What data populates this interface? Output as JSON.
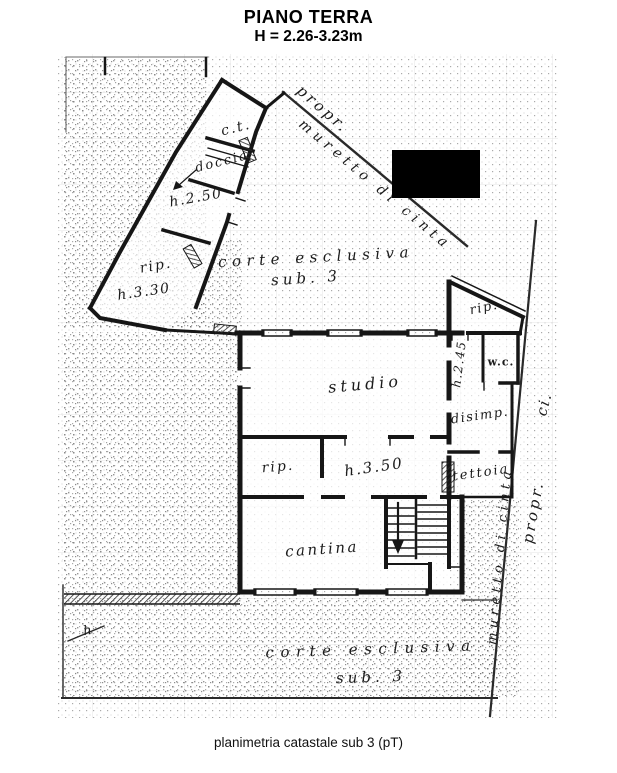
{
  "header": {
    "title": "PIANO TERRA",
    "subtitle": "H = 2.26-3.23m"
  },
  "caption": "planimetria catastale sub 3 (pT)",
  "colors": {
    "paper": "#ffffff",
    "ink": "#161616",
    "boundary": "#2a2a2a",
    "speckle": "#9b9b9b",
    "redaction": "#000000"
  },
  "plan": {
    "redaction_box": {
      "x": 392,
      "y": 150,
      "w": 88,
      "h": 48
    },
    "labels": [
      {
        "id": "ct",
        "text": "c.t.",
        "x": 236,
        "y": 128,
        "rot": -14,
        "size": 14,
        "ls": 2
      },
      {
        "id": "doccia",
        "text": "doccia",
        "x": 222,
        "y": 162,
        "rot": -14,
        "size": 13,
        "ls": 2
      },
      {
        "id": "h250",
        "text": "h.2.50",
        "x": 196,
        "y": 198,
        "rot": -10,
        "size": 14,
        "ls": 1.5
      },
      {
        "id": "rip-wing",
        "text": "rip.",
        "x": 156,
        "y": 266,
        "rot": -10,
        "size": 14,
        "ls": 2
      },
      {
        "id": "h330",
        "text": "h.3.30",
        "x": 144,
        "y": 292,
        "rot": -8,
        "size": 14,
        "ls": 1.5
      },
      {
        "id": "corte-top-line1",
        "text": "corte esclusiva",
        "x": 316,
        "y": 257,
        "rot": -3,
        "size": 15,
        "ls": 5.5
      },
      {
        "id": "corte-top-line2",
        "text": "sub. 3",
        "x": 306,
        "y": 278,
        "rot": -4,
        "size": 15,
        "ls": 4
      },
      {
        "id": "propr-top",
        "text": "propr.",
        "x": 323,
        "y": 109,
        "rot": 41,
        "size": 15,
        "ls": 3
      },
      {
        "id": "muretto-top",
        "text": "muretto di cinta",
        "x": 375,
        "y": 185,
        "rot": 40,
        "size": 14,
        "ls": 5
      },
      {
        "id": "studio",
        "text": "studio",
        "x": 365,
        "y": 384,
        "rot": -5,
        "size": 16,
        "ls": 4
      },
      {
        "id": "rip-right",
        "text": "rip.",
        "x": 484,
        "y": 308,
        "rot": -12,
        "size": 13,
        "ls": 1.5
      },
      {
        "id": "wc",
        "text": "w.c.",
        "x": 501,
        "y": 362,
        "rot": 0,
        "size": 11,
        "ls": 1,
        "bold": true
      },
      {
        "id": "h245",
        "text": "h.2.45",
        "x": 459,
        "y": 364,
        "rot": -83,
        "size": 12,
        "ls": 1.5
      },
      {
        "id": "disimp",
        "text": "disimp.",
        "x": 480,
        "y": 416,
        "rot": -8,
        "size": 13,
        "ls": 1.5
      },
      {
        "id": "rip-mid",
        "text": "rip.",
        "x": 278,
        "y": 467,
        "rot": -5,
        "size": 14,
        "ls": 2
      },
      {
        "id": "h350",
        "text": "h.3.50",
        "x": 374,
        "y": 467,
        "rot": -8,
        "size": 15,
        "ls": 2
      },
      {
        "id": "tettoia",
        "text": "tettoia",
        "x": 481,
        "y": 473,
        "rot": -8,
        "size": 13,
        "ls": 2
      },
      {
        "id": "cantina",
        "text": "cantina",
        "x": 322,
        "y": 549,
        "rot": -4,
        "size": 15,
        "ls": 2.5
      },
      {
        "id": "corte-bot-line1",
        "text": "corte esclusiva",
        "x": 371,
        "y": 649,
        "rot": -2,
        "size": 15,
        "ls": 6.5
      },
      {
        "id": "corte-bot-line2",
        "text": "sub. 3",
        "x": 371,
        "y": 677,
        "rot": -2,
        "size": 15,
        "ls": 4
      },
      {
        "id": "h-small",
        "text": "h",
        "x": 88,
        "y": 631,
        "rot": -10,
        "size": 13,
        "ls": 1
      },
      {
        "id": "muretto-right",
        "text": "muretto di cinta",
        "x": 500,
        "y": 556,
        "rot": -85,
        "size": 13,
        "ls": 4.5
      },
      {
        "id": "propr-right",
        "text": "propr.",
        "x": 533,
        "y": 512,
        "rot": -80,
        "size": 15,
        "ls": 3
      },
      {
        "id": "ci-right",
        "text": "ci.",
        "x": 544,
        "y": 404,
        "rot": -75,
        "size": 15,
        "ls": 2
      }
    ]
  }
}
